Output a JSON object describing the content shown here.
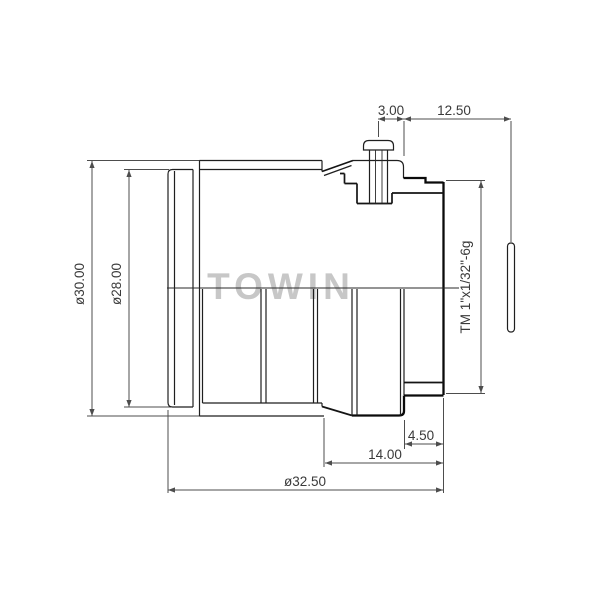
{
  "drawing": {
    "watermark": "TOWIN",
    "labels": {
      "screw_to_flange": "3.00",
      "flange_focal_distance": "12.50",
      "body_diameter": "ø30.00",
      "front_diameter": "ø28.00",
      "mount_thread": "TM 1\"x1/32\"-6g",
      "thread_length": "4.50",
      "rear_section_length": "14.00",
      "overall_length": "ø32.50"
    }
  }
}
